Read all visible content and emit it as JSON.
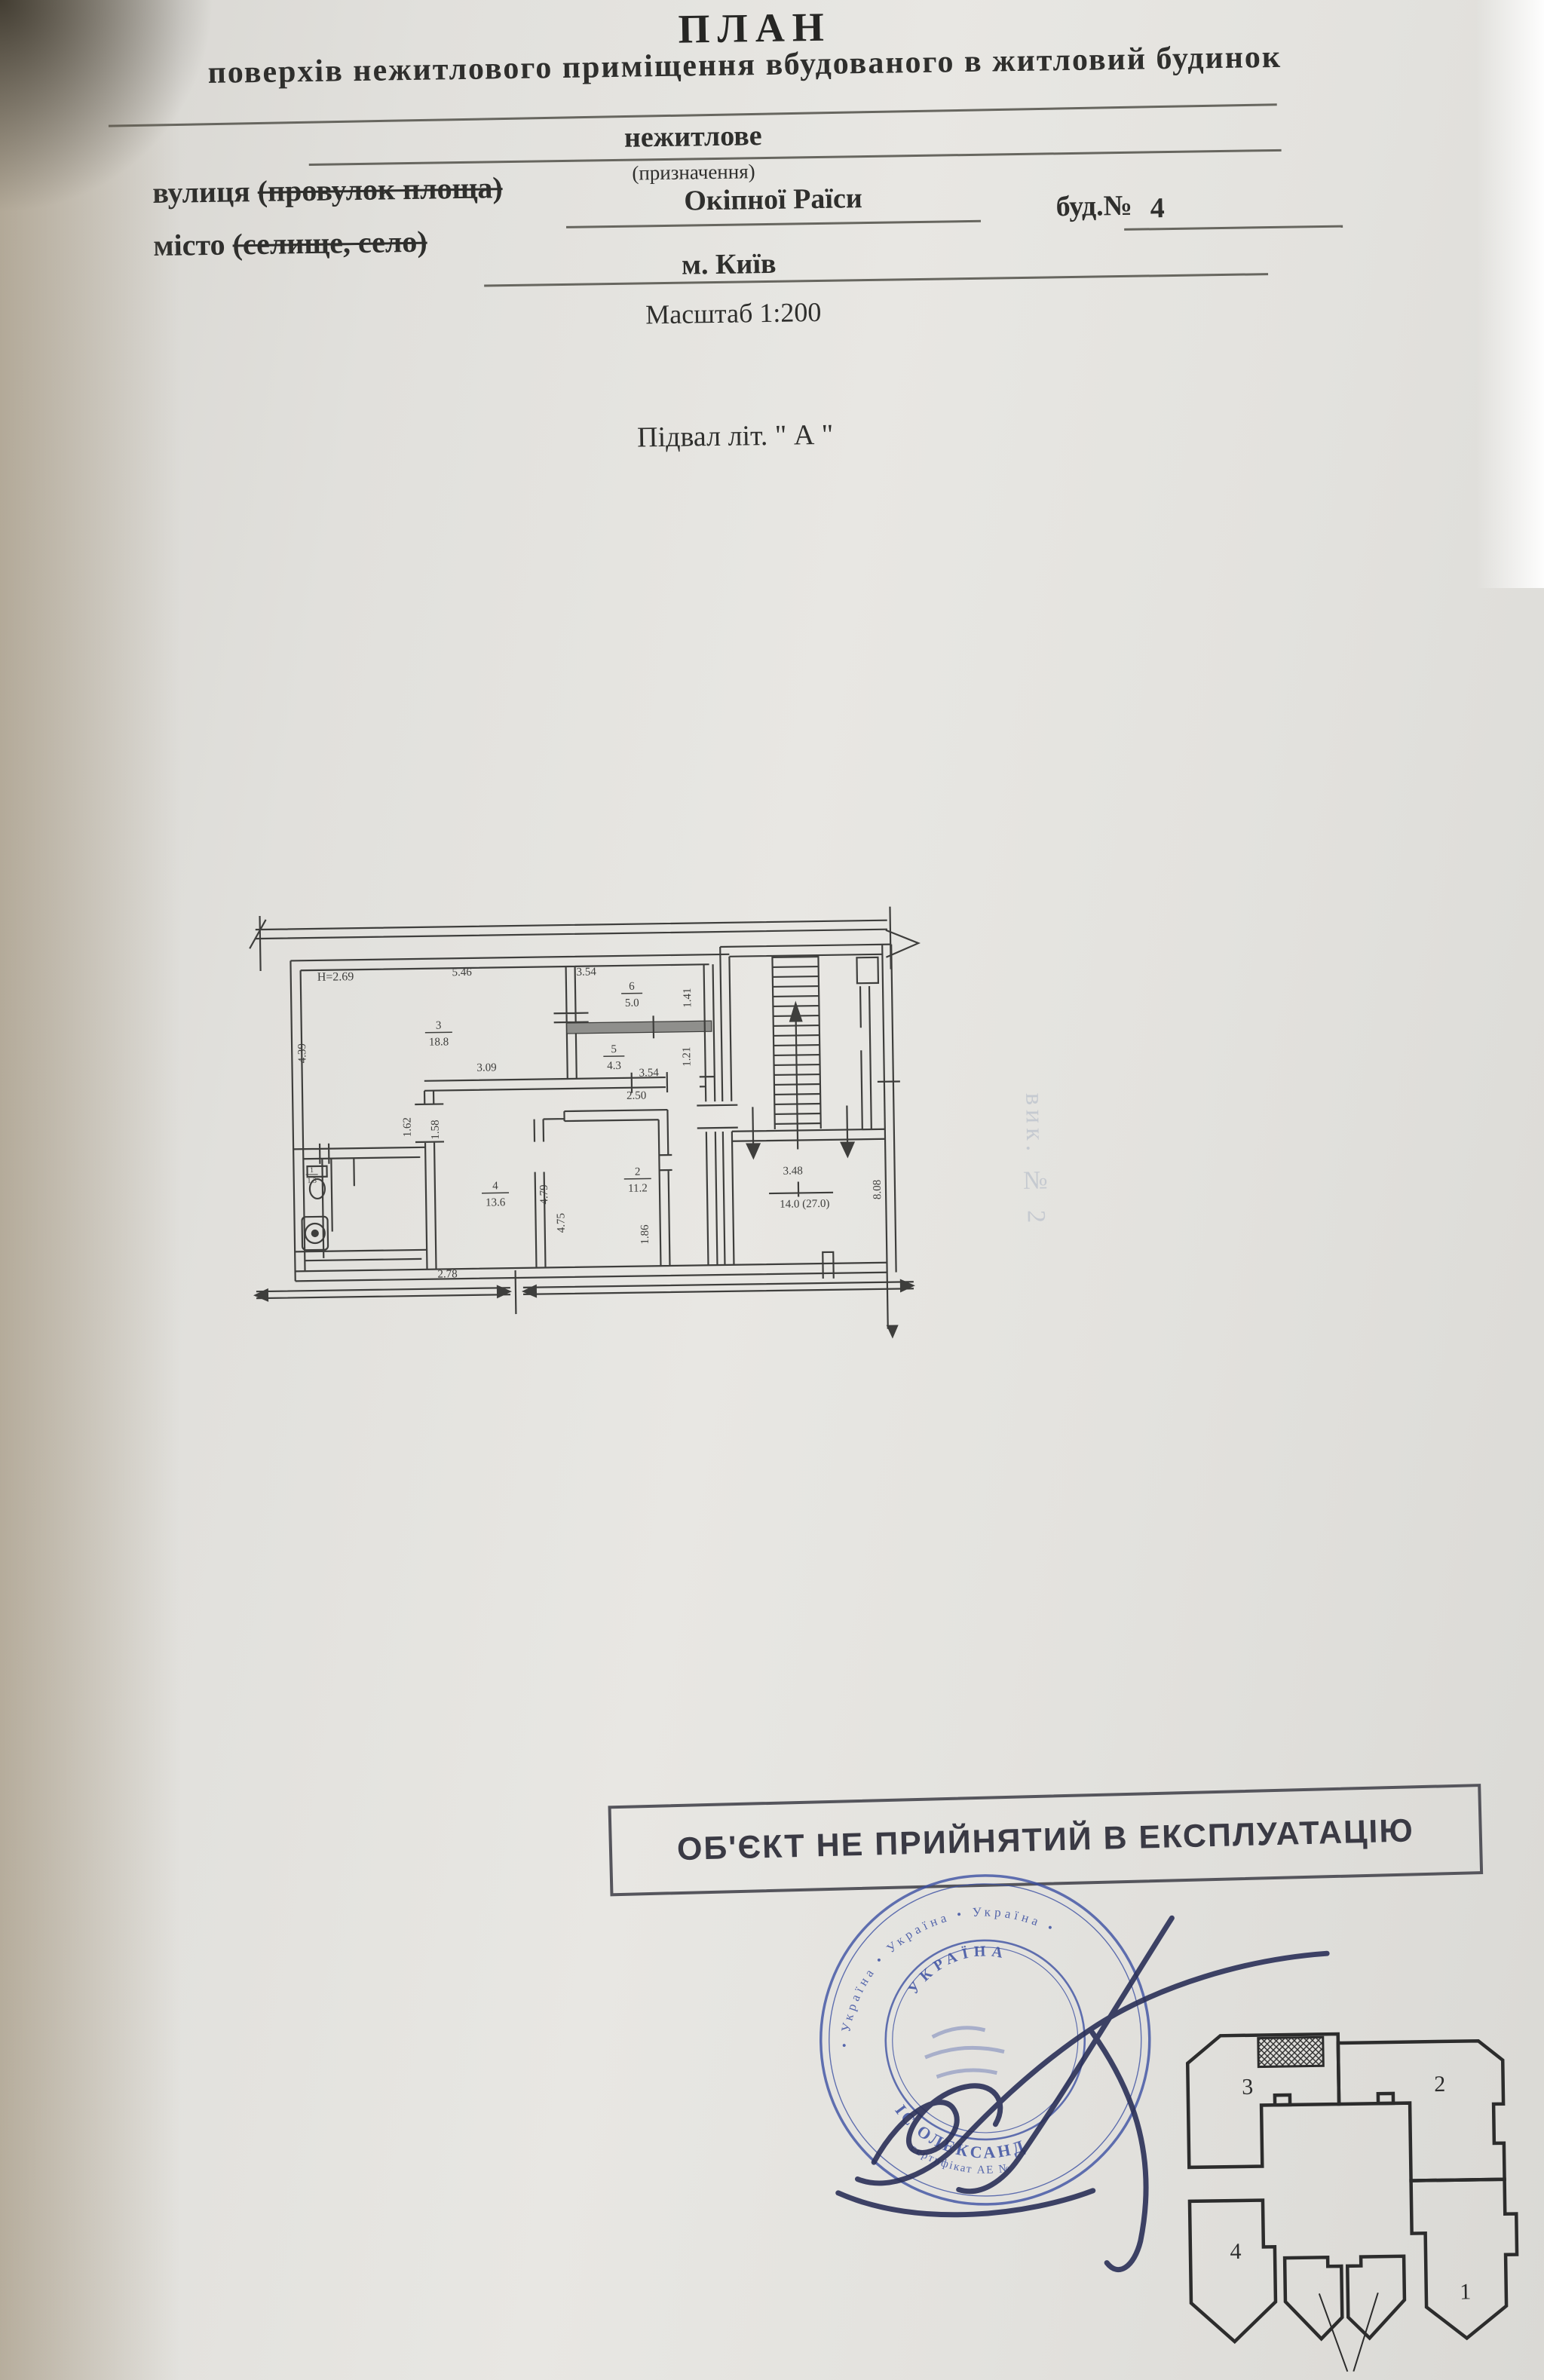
{
  "page": {
    "title": "ПЛАН",
    "subtitle": "поверхів нежитлового приміщення вбудованого в житловий будинок",
    "purpose_value": "нежитлове",
    "purpose_caption": "(призначення)",
    "street_label_main": "вулиця ",
    "street_label_paren": "(провулок площа)",
    "street_value": "Окіпної Раїси",
    "house_label": "буд.№",
    "house_value": "4",
    "city_label_main": "місто ",
    "city_label_paren": "(селище, село)",
    "city_value": "м. Київ",
    "scale_label": "Масштаб 1:200",
    "floor_label": "Підвал літ. \" А \""
  },
  "plan": {
    "height_mark": "H=2.69",
    "stair_area": "14.0 (27.0)",
    "dims": {
      "d546": "5.46",
      "d354a": "3.54",
      "d141": "1.41",
      "d439": "4.39",
      "d309": "3.09",
      "d354b": "3.54",
      "d121": "1.21",
      "d250": "2.50",
      "d162": "1.62",
      "d158": "1.58",
      "d479": "4.79",
      "d475": "4.75",
      "d186": "1.86",
      "d278": "2.78",
      "d348": "3.48",
      "d808": "8.08"
    },
    "rooms": [
      {
        "num": "3",
        "area": "18.8"
      },
      {
        "num": "6",
        "area": "5.0"
      },
      {
        "num": "5",
        "area": "4.3"
      },
      {
        "num": "2",
        "area": "11.2"
      },
      {
        "num": "4",
        "area": "13.6"
      },
      {
        "num": "1",
        "area": "1.3"
      }
    ]
  },
  "bleed_note": "вик. № 2",
  "stamp": {
    "text": "ОБ'ЄКТ НЕ ПРИЙНЯТИЙ В ЕКСПЛУАТАЦІЮ"
  },
  "seal": {
    "outer_arc": "• Україна  •  Україна  •  Україна •",
    "top_arc": "УКРАЇНА",
    "name_arc": "ІС ОЛЕКСАНД",
    "cert_arc": "сертифікат АЕ №"
  },
  "key_plan": {
    "sections": [
      "1",
      "2",
      "3",
      "4"
    ]
  }
}
